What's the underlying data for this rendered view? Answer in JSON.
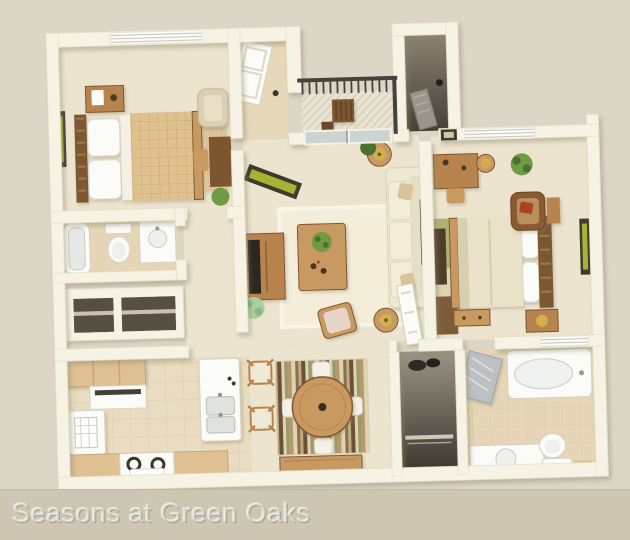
{
  "caption": {
    "text": "Seasons at Green Oaks"
  },
  "colors": {
    "bg": "#dcd6c6",
    "bar": "#ccc6b3",
    "caption-ink": "rgba(255,255,255,0.42)",
    "wall": "#f6f2e4",
    "wall-shade": "#ddd5c0",
    "carpet": "#ece4cf",
    "carpet-light": "#f3edd9",
    "tile": "#e9dcc0",
    "bath-tile": "#e6d6b7",
    "entry-tile": "#e6d8b8",
    "deck": "#e9e3d3",
    "wood": "#b8834d",
    "wood-mid": "#c89a62",
    "wood-dark": "#7d5630",
    "wood-light": "#dfc194",
    "duvet": "#dfc08f",
    "duvet-grid": "#c3a06c",
    "cream": "#efe9d4",
    "white-fix": "#fbfbf7",
    "fix-shade": "#d8d8d0",
    "glass": "#ccd4d2",
    "dark-int": "#575043",
    "darker": "#35302a",
    "railing": "#45413b",
    "green": "#6f9b43",
    "green-dark": "#4c7032",
    "mint": "#a9cfa2",
    "art-green": "#a6b52f",
    "gold": "#d2ae4e",
    "red": "#ae412c",
    "steel": "#bcc0c2"
  },
  "floorplan": {
    "style": "3d-rendered top-down apartment floor plan",
    "rooms": [
      {
        "id": "bedroom-1",
        "furniture": [
          "bed",
          "headboard",
          "pillows",
          "nightstand",
          "table-lamp",
          "wall-art",
          "window-blinds",
          "armchair",
          "desk",
          "desk-chair",
          "plant"
        ]
      },
      {
        "id": "bathroom-1",
        "furniture": [
          "bathtub",
          "toilet",
          "vanity-sink"
        ]
      },
      {
        "id": "hall-closets",
        "furniture": [
          "closet",
          "closet-shelf"
        ]
      },
      {
        "id": "entry",
        "furniture": [
          "front-door"
        ]
      },
      {
        "id": "balcony",
        "furniture": [
          "railing",
          "deck",
          "bistro-table",
          "bistro-chair"
        ]
      },
      {
        "id": "storage-closet",
        "furniture": [
          "closet-door"
        ]
      },
      {
        "id": "living-room",
        "furniture": [
          "sofa",
          "end-table-lamp",
          "end-table-lamp",
          "coffee-table",
          "coffee-table-plant",
          "tv-console",
          "tv",
          "wall-art",
          "area-rug",
          "armchair",
          "sliding-glass-door",
          "floor-plant",
          "door-plant"
        ]
      },
      {
        "id": "bedroom-2",
        "furniture": [
          "bed",
          "headboard",
          "pillows",
          "bench-trunk",
          "dresser",
          "nightstand",
          "table-lamp",
          "desk",
          "desk-chair",
          "side-table-lamp",
          "armchair",
          "red-pillow",
          "runner-rug",
          "window-blinds",
          "wall-art",
          "wall-art",
          "plant",
          "window"
        ]
      },
      {
        "id": "kitchen",
        "furniture": [
          "upper-cabinets",
          "range-hood",
          "refrigerator",
          "calendar",
          "counter",
          "range",
          "towel",
          "sink-island",
          "double-sink",
          "bar-stool",
          "bar-stool"
        ]
      },
      {
        "id": "dining",
        "furniture": [
          "round-table",
          "dining-chair",
          "dining-chair",
          "dining-chair",
          "dining-chair",
          "striped-rug",
          "sideboard"
        ]
      },
      {
        "id": "laundry-closet",
        "furniture": [
          "wire-shelf",
          "open-door"
        ]
      },
      {
        "id": "bathroom-2",
        "furniture": [
          "shower-door",
          "bathtub",
          "toilet",
          "vanity-sink",
          "tray-mat"
        ]
      }
    ]
  }
}
